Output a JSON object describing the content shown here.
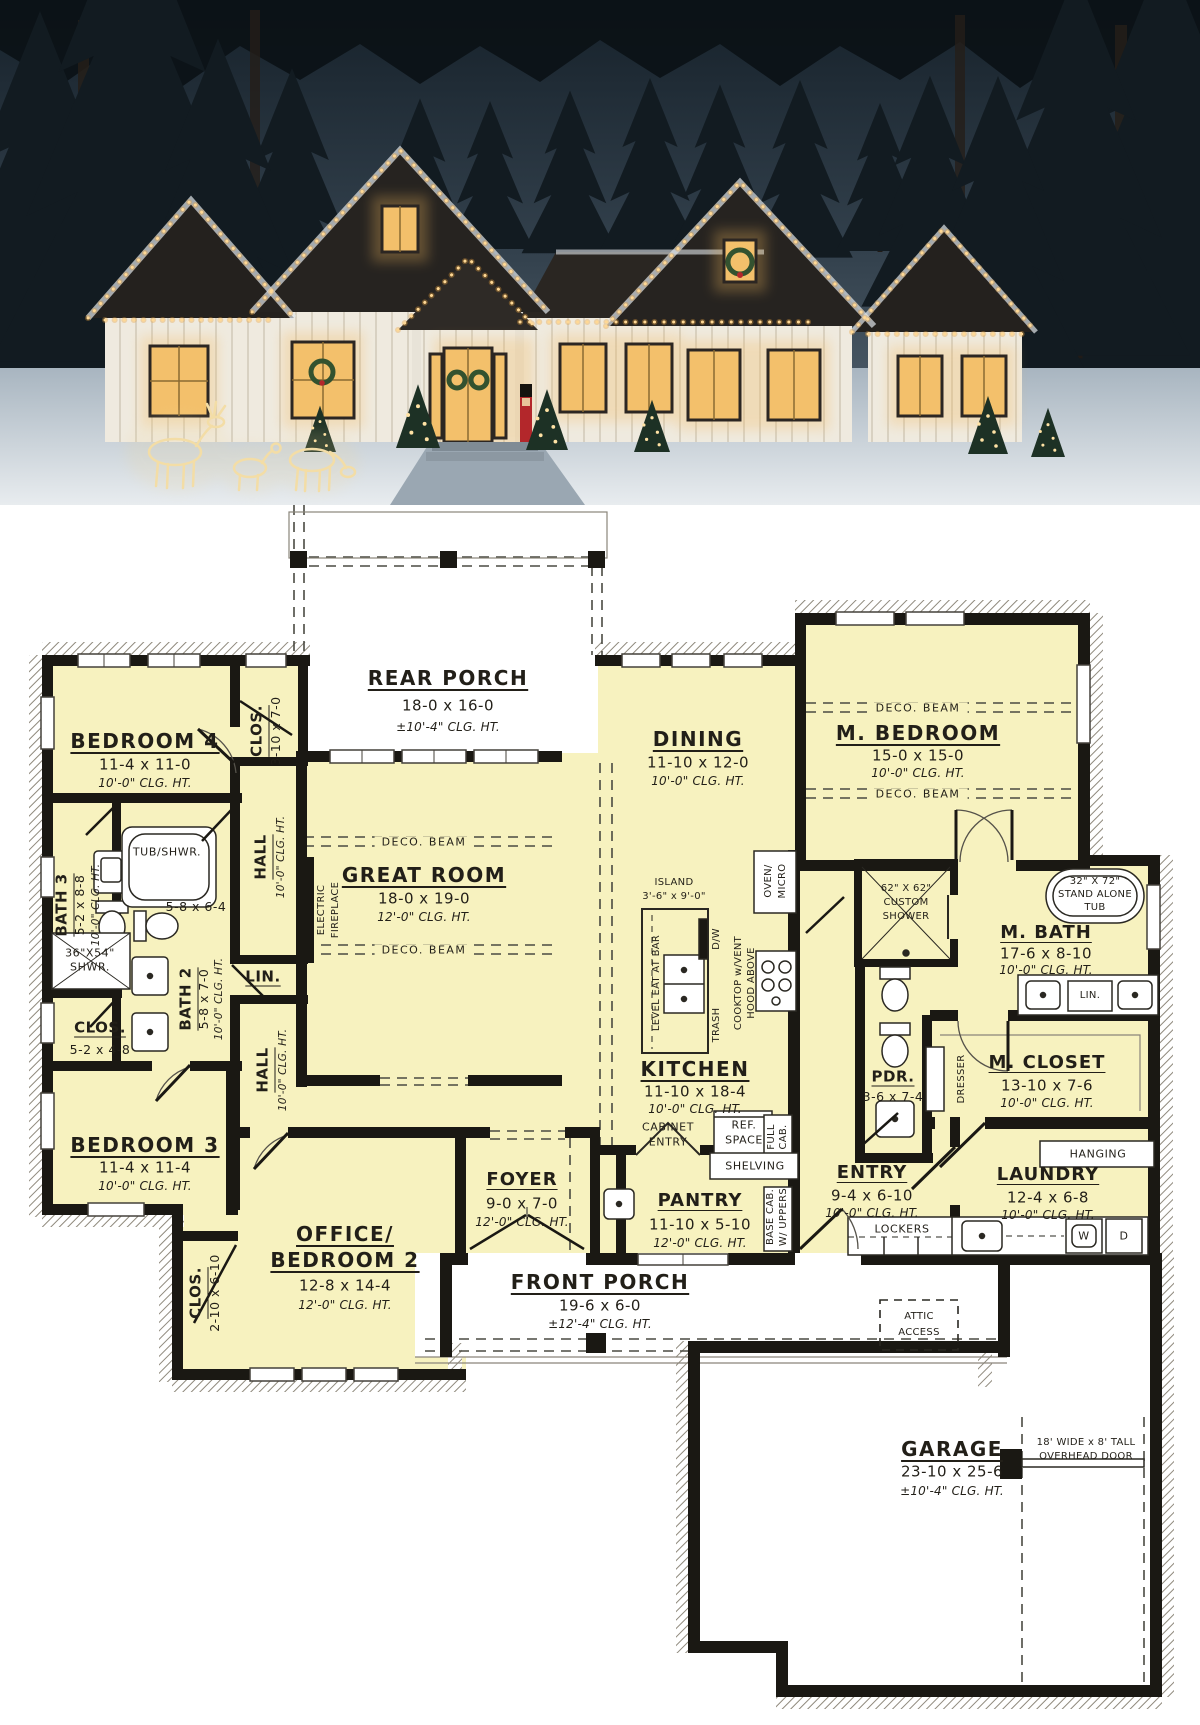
{
  "colors": {
    "plan_room_fill": "#f7f2bf",
    "plan_wall": "#1a1813",
    "plan_paper": "#ffffff",
    "photo_sky": "#1c2730",
    "photo_snow": "#e6eaee",
    "photo_lights": "#ffd894"
  },
  "plan": {
    "rear_porch": {
      "name": "REAR PORCH",
      "dims": "18-0 x 16-0",
      "clg": "±10'-4\" CLG. HT."
    },
    "great_room": {
      "name": "GREAT ROOM",
      "dims": "18-0 x 19-0",
      "clg": "12'-0\" CLG. HT."
    },
    "dining": {
      "name": "DINING",
      "dims": "11-10 x 12-0",
      "clg": "10'-0\" CLG. HT."
    },
    "m_bedroom": {
      "name": "M. BEDROOM",
      "dims": "15-0 x 15-0",
      "clg": "10'-0\" CLG. HT."
    },
    "kitchen": {
      "name": "KITCHEN",
      "dims": "11-10 x 18-4",
      "clg": "10'-0\" CLG. HT."
    },
    "bedroom4": {
      "name": "BEDROOM 4",
      "dims": "11-4 x 11-0",
      "clg": "10'-0\" CLG. HT."
    },
    "bedroom3": {
      "name": "BEDROOM 3",
      "dims": "11-4 x 11-4",
      "clg": "10'-0\" CLG. HT."
    },
    "office": {
      "name_line1": "OFFICE/",
      "name_line2": "BEDROOM 2",
      "dims": "12-8 x 14-4",
      "clg": "12'-0\" CLG. HT."
    },
    "foyer": {
      "name": "FOYER",
      "dims": "9-0 x 7-0",
      "clg": "12'-0\" CLG. HT."
    },
    "pantry": {
      "name": "PANTRY",
      "dims": "11-10 x 5-10",
      "clg": "12'-0\" CLG. HT."
    },
    "entry": {
      "name": "ENTRY",
      "dims": "9-4 x 6-10",
      "clg": "10'-0\" CLG. HT."
    },
    "laundry": {
      "name": "LAUNDRY",
      "dims": "12-4 x 6-8",
      "clg": "10'-0\" CLG. HT."
    },
    "m_bath": {
      "name": "M. BATH",
      "dims": "17-6 x 8-10",
      "clg": "10'-0\" CLG. HT."
    },
    "m_closet": {
      "name": "M. CLOSET",
      "dims": "13-10 x 7-6",
      "clg": "10'-0\" CLG. HT."
    },
    "pdr": {
      "name": "PDR.",
      "dims": "3-6 x 7-4"
    },
    "bath2": {
      "name": "BATH 2",
      "dims": "5-8 x 7-0",
      "clg": "10'-0\" CLG. HT."
    },
    "bath3": {
      "name": "BATH 3",
      "dims": "5-2 x 8-8",
      "clg": "10'-0\" CLG. HT."
    },
    "hall_upper": {
      "name": "HALL",
      "clg": "10'-0\" CLG. HT."
    },
    "hall_lower": {
      "name": "HALL",
      "clg": "10'-0\" CLG. HT."
    },
    "clos_bedroom4": {
      "name": "CLOS.",
      "dims": "3-10 x 7-0"
    },
    "clos_bedroom3": {
      "name": "CLOS.",
      "dims": "5-2 x 4-8"
    },
    "clos_office": {
      "name": "CLOS.",
      "dims": "2-10 x 6-10"
    },
    "front_porch": {
      "name": "FRONT PORCH",
      "dims": "19-6 x 6-0",
      "clg": "±12'-4\" CLG. HT."
    },
    "garage": {
      "name": "GARAGE",
      "dims": "23-10 x 25-6",
      "clg": "±10'-4\" CLG. HT."
    },
    "island": {
      "name": "ISLAND",
      "dims": "3'-6\" x 9'-0\""
    },
    "features": {
      "deco_beam": "DECO. BEAM",
      "electric_fireplace_1": "ELECTRIC",
      "electric_fireplace_2": "FIREPLACE",
      "tub_shwr": "TUB/SHWR.",
      "corner_shwr_1": "36\"X54\"",
      "corner_shwr_2": "SHWR.",
      "bath2_tub_dims": "5-8 x 6-4",
      "lin": "LIN.",
      "level_eat_at_bar": "LEVEL EAT AT BAR",
      "dw": "D/W",
      "trash": "TRASH",
      "cooktop_1": "COOKTOP w/VENT",
      "cooktop_2": "HOOD ABOVE",
      "oven_1": "OVEN/",
      "oven_2": "MICRO",
      "cabinet_entry_1": "CABINET",
      "cabinet_entry_2": "ENTRY",
      "ref_space_1": "REF.",
      "ref_space_2": "SPACE",
      "full_cab_1": "FULL",
      "full_cab_2": "CAB.",
      "shelving": "SHELVING",
      "base_cab_1": "BASE CAB.",
      "base_cab_2": "W/ UPPERS",
      "custom_shower_1": "62\" X 62\"",
      "custom_shower_2": "CUSTOM",
      "custom_shower_3": "SHOWER",
      "stand_tub_1": "32\" X 72\"",
      "stand_tub_2": "STAND ALONE",
      "stand_tub_3": "TUB",
      "dresser": "DRESSER",
      "hanging": "HANGING",
      "lockers": "LOCKERS",
      "washer": "W",
      "dryer": "D",
      "attic_1": "ATTIC",
      "attic_2": "ACCESS",
      "overhead_door_1": "18' WIDE x 8' TALL",
      "overhead_door_2": "OVERHEAD DOOR"
    }
  }
}
